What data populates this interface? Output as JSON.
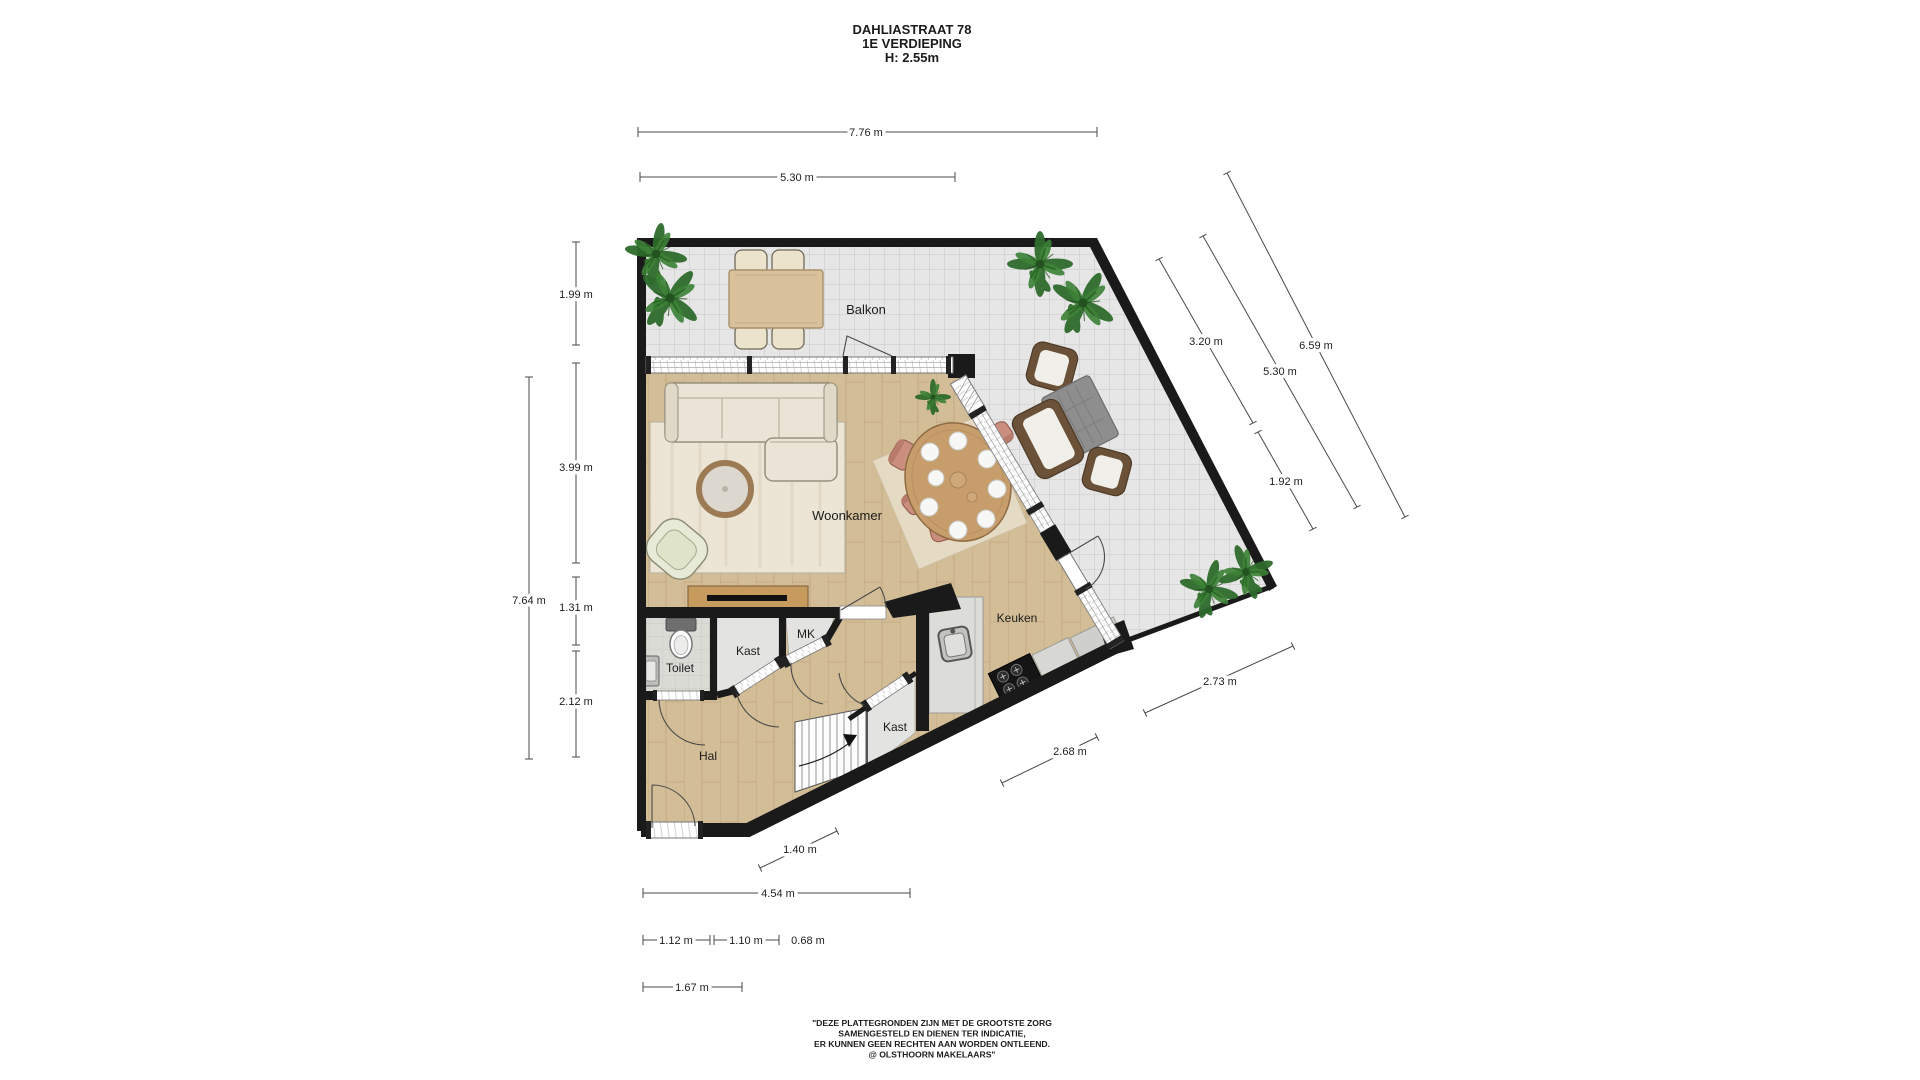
{
  "title": {
    "address": "DAHLIASTRAAT 78",
    "floor": "1E VERDIEPING",
    "ceiling_height": "H: 2.55m"
  },
  "rooms": {
    "balkon": "Balkon",
    "woonkamer": "Woonkamer",
    "keuken": "Keuken",
    "toilet": "Toilet",
    "kast": "Kast",
    "mk": "MK",
    "kast2": "Kast",
    "hal": "Hal"
  },
  "dimensions": {
    "top_total": "7.76 m",
    "top_balkon": "5.30 m",
    "left_balkon": "1.99 m",
    "left_woonkamer": "3.99 m",
    "left_total": "7.64 m",
    "left_toilet": "1.31 m",
    "left_hal": "2.12 m",
    "right_balkon_width": "3.20 m",
    "right_total": "6.59 m",
    "right_mid": "5.30 m",
    "right_lower": "1.92 m",
    "balkon_bottom": "2.73 m",
    "keuken_diag": "2.68 m",
    "hal_diag": "1.40 m",
    "bottom_total": "4.54 m",
    "bottom_seg1": "1.12 m",
    "bottom_seg2": "1.10 m",
    "bottom_seg3": "0.68 m",
    "bottom_left": "1.67 m"
  },
  "disclaimer": {
    "line1": "\"DEZE PLATTEGRONDEN ZIJN MET DE GROOTSTE ZORG",
    "line2": "SAMENGESTELD EN DIENEN TER INDICATIE,",
    "line3": "ER KUNNEN GEEN RECHTEN AAN WORDEN ONTLEEND.",
    "line4": "@ OLSTHOORN MAKELAARS\""
  },
  "colors": {
    "wall": "#1a1a1a",
    "balcony_tile": "#e6e6e6",
    "wood": "#d3bd97",
    "room_gray": "#e3e3e1",
    "toilet_tile": "#dbdbd6",
    "plant_green": "#2f6b2c"
  }
}
